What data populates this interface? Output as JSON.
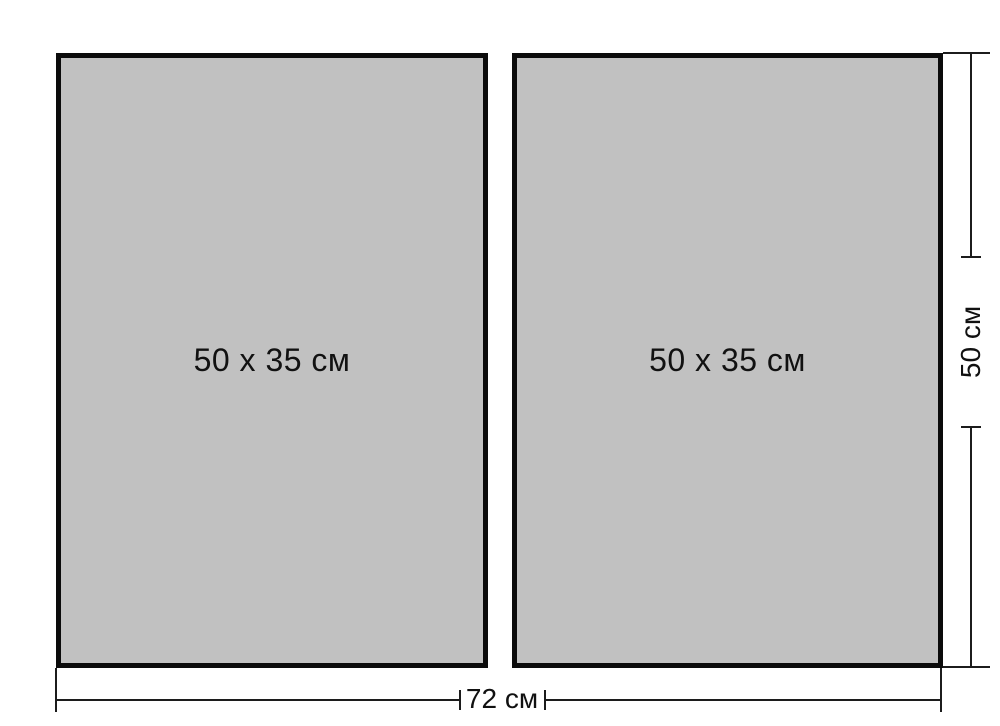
{
  "diagram": {
    "panels": [
      {
        "label": "50 x 35 см"
      },
      {
        "label": "50 x 35 см"
      }
    ],
    "dimensions": {
      "width_label": "72 см",
      "height_label": "50 см"
    },
    "colors": {
      "background": "#ffffff",
      "panel_fill": "#c1c1c1",
      "panel_border": "#0b0b0b",
      "line": "#1c1c1c",
      "text": "#111111"
    }
  }
}
